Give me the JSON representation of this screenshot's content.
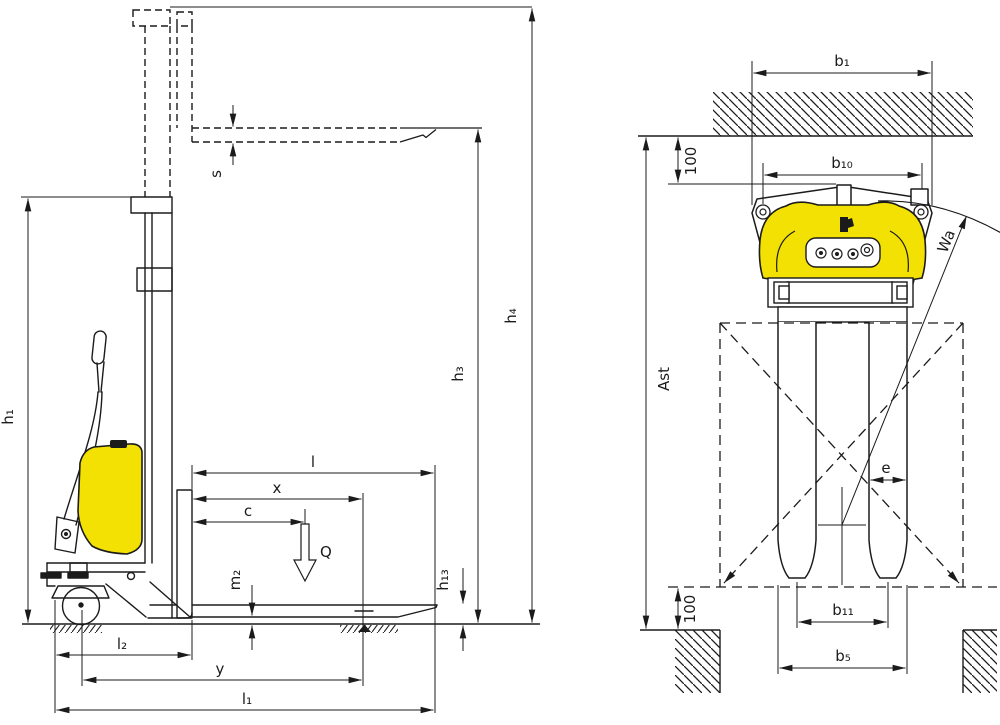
{
  "diagram": {
    "type": "technical-dimension-drawing",
    "subject": "electric pallet stacker, side view and top (plan) view",
    "colors": {
      "line": "#1b1b1b",
      "accent_yellow": "#f4e104",
      "background": "#ffffff"
    },
    "labels": {
      "side": {
        "h1": "h₁",
        "h3": "h₃",
        "h4": "h₄",
        "h13": "h₁₃",
        "s": "s",
        "m2": "m₂",
        "load": "Q",
        "l": "l",
        "x": "x",
        "c": "c",
        "l2": "l₂",
        "y": "y",
        "l1": "l₁"
      },
      "top": {
        "b1": "b₁",
        "b10": "b₁₀",
        "b11": "b₁₁",
        "b5": "b₅",
        "e": "e",
        "ast": "Ast",
        "wa": "Wa",
        "top_clearance": "100",
        "bottom_clearance": "100"
      }
    }
  }
}
